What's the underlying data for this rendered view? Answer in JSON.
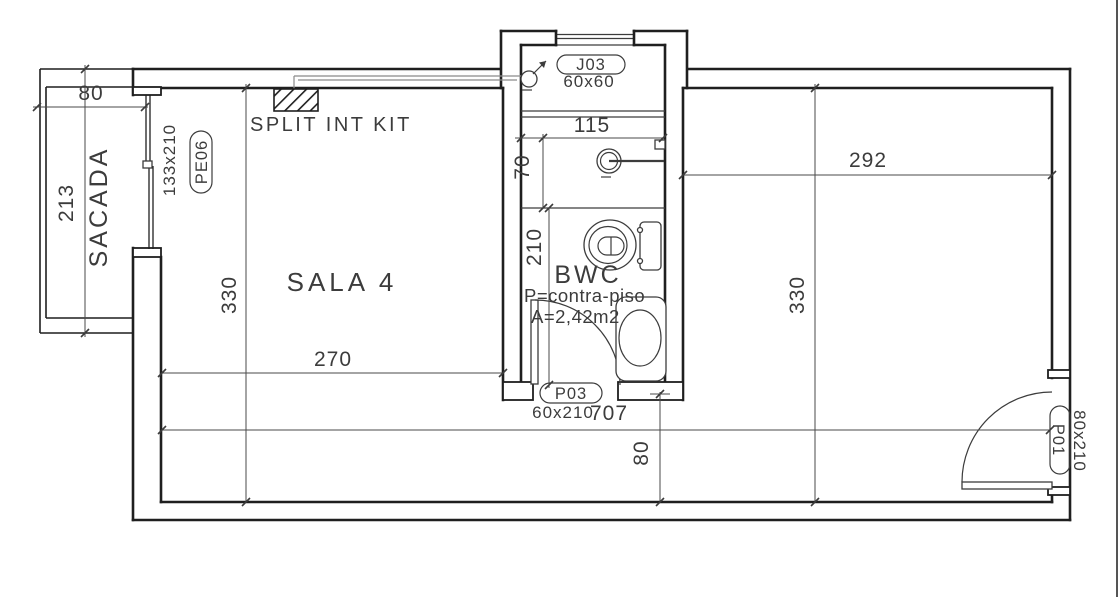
{
  "rooms": {
    "sala": "SALA 4",
    "sacada": "SACADA",
    "bwc": "BWC",
    "bwc_floor_note": "P=contra-piso",
    "bwc_area_note": "A=2,42m2"
  },
  "annotations": {
    "split_unit": "SPLIT INT KIT"
  },
  "openings": {
    "j03_code": "J03",
    "j03_size": "60x60",
    "pe06_code": "PE06",
    "pe06_size": "133x210",
    "p03_code": "P03",
    "p03_size": "60x210",
    "p01_code": "P01",
    "p01_size": "80x210"
  },
  "dims": {
    "sacada_width": "80",
    "sacada_depth": "213",
    "sala_depth_left": "330",
    "sala_width": "270",
    "bwc_width": "115",
    "shower_depth": "70",
    "bwc_depth": "210",
    "room_depth_right": "330",
    "right_width": "292",
    "total_width": "707",
    "passage_depth": "80"
  },
  "colors": {
    "wall": "#1f1f1f",
    "thin_line": "#3c3c3c",
    "pipe_line": "#8a8a8a",
    "background": "#ffffff"
  }
}
